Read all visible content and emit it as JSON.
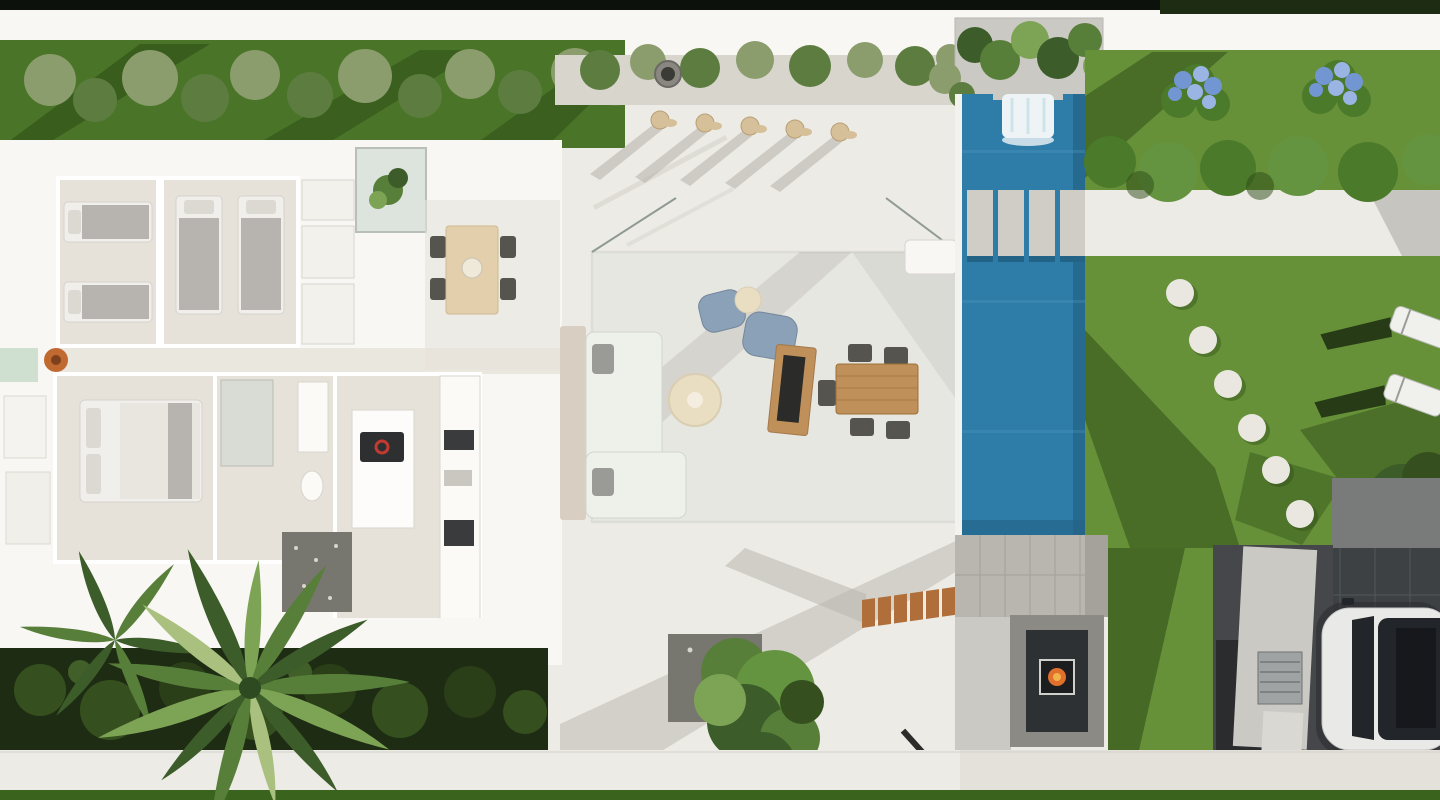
{
  "colors": {
    "strip_dark": "#0c120b",
    "wall_white": "#f8f7f4",
    "patio": "#edebe5",
    "patio_shadow": "#b9b6ae",
    "grass_dark": "#4a7427",
    "grass_shadow": "#2c4a16",
    "grass_lawn": "#679139",
    "lawn_light": "#79a748",
    "grass_bottom": "#3a641d",
    "hedge_dark": "#1e2c13",
    "hedge_leaf": "#35501e",
    "shrub_olive": "#8b9c6d",
    "shrub_green": "#5d7d40",
    "gravel": "#d8d5cd",
    "gravel_dark": "#77766f",
    "floor_interior": "#e6e2da",
    "bed_blanket": "#b7b3ae",
    "bed_sheet": "#f1efeb",
    "pillow": "#dcd8d2",
    "wood_light": "#e3cfac",
    "wood_mid": "#c0905a",
    "wood_steps": "#b06f3a",
    "chair_dark": "#55544f",
    "sofa": "#edf1ea",
    "table_cream": "#e9ddc2",
    "pouf_blue": "#8ba1b7",
    "glass": "#ccd8cf",
    "glass_edge": "#8f9a93",
    "pool": "#2e7da9",
    "pool_dark": "#236386",
    "pool_light": "#4f97bd",
    "waterfall": "#eef4f6",
    "step_slab": "#cfcdc6",
    "coping": "#f3f2ee",
    "paving_gray": "#b9b6af",
    "fireplace_dark": "#2e3134",
    "fire_orange": "#e0702c",
    "fire_yellow": "#f2b24a",
    "concrete": "#cbc9c3",
    "drive_dark": "#3e4143",
    "drive_light": "#787b79",
    "car_body": "#e9eae7",
    "car_glass": "#22252a",
    "stone_white": "#e9e7df",
    "hydrangea": "#7296d2",
    "hydrangea_light": "#9ab4e4",
    "bush_green": "#4b7a2b",
    "bush_light": "#659440",
    "palm_dark": "#3c5c2a",
    "palm_mid": "#587f3a",
    "palm_light": "#7da355",
    "palm_pale": "#a9c07e",
    "towel": "#d6c09a",
    "mint_panel": "#cfe0d1",
    "terracotta": "#c06a31",
    "steel": "#9fa3a4"
  },
  "scene": {
    "type": "aerial-3d-villa-render",
    "objects": [
      {
        "name": "single-beds",
        "count": 4
      },
      {
        "name": "double-bed",
        "count": 1
      },
      {
        "name": "sun-lounger-towels",
        "count": 5
      },
      {
        "name": "garden-loungers",
        "count": 2
      },
      {
        "name": "pool",
        "count": 1
      },
      {
        "name": "pool-waterfall",
        "count": 1
      },
      {
        "name": "pool-step-slabs",
        "count": 4
      },
      {
        "name": "stepping-stones",
        "count": 6
      },
      {
        "name": "hydrangea-bushes",
        "count": 2
      },
      {
        "name": "outdoor-fireplace",
        "count": 1
      },
      {
        "name": "outdoor-kitchen",
        "count": 1
      },
      {
        "name": "car",
        "count": 1
      },
      {
        "name": "palm-tree",
        "count": 1
      },
      {
        "name": "garden-tree",
        "count": 2
      }
    ]
  }
}
